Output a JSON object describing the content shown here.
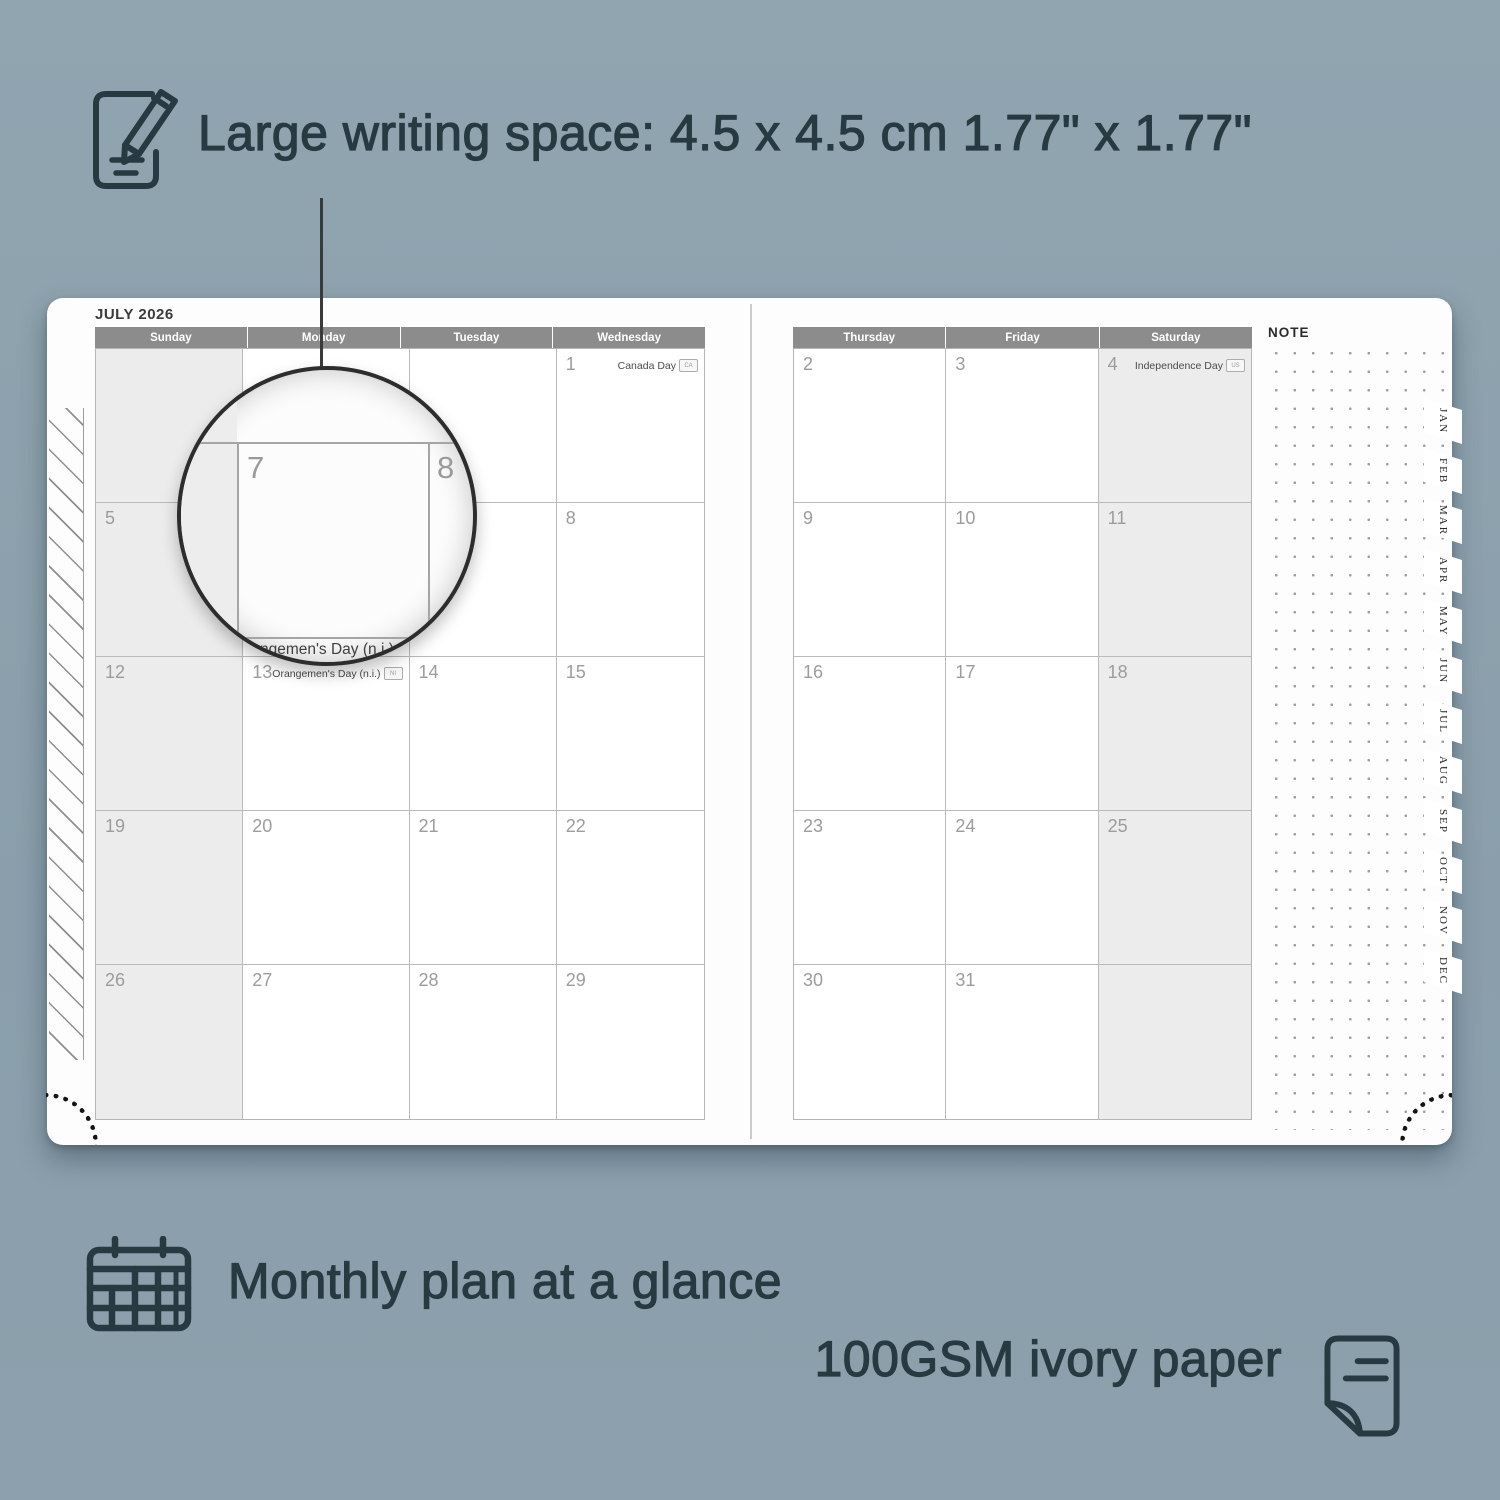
{
  "colors": {
    "background": "#8CA1AD",
    "ink": "#273A41",
    "page": "#FDFDFD",
    "header_bar": "#8C8C8C",
    "header_text": "#FFFFFF",
    "shaded_cell": "#ECECEC",
    "grid_line": "#B5B5B5",
    "date_number": "#9C9C9C"
  },
  "icons": {
    "top": "notepad-pencil-icon",
    "bottom_left": "calendar-grid-icon",
    "bottom_right": "paper-sheet-icon"
  },
  "annotations": {
    "top_label": "Large writing space: 4.5 x 4.5 cm  1.77\" x 1.77\"",
    "bottom_left_label": "Monthly plan at a glance",
    "bottom_right_label": "100GSM ivory paper"
  },
  "planner": {
    "month_title": "JULY 2026",
    "note_label": "NOTE",
    "weekday_headers_left": [
      "Sunday",
      "Monday",
      "Tuesday",
      "Wednesday"
    ],
    "weekday_headers_right": [
      "Thursday",
      "Friday",
      "Saturday"
    ],
    "month_tabs": [
      "JAN",
      "FEB",
      "MAR",
      "APR",
      "MAY",
      "JUN",
      "JUL",
      "AUG",
      "SEP",
      "OCT",
      "NOV",
      "DEC"
    ],
    "left_grid": [
      [
        {
          "date": "",
          "shaded": true
        },
        {
          "date": ""
        },
        {
          "date": ""
        },
        {
          "date": "1",
          "holiday": "Canada Day",
          "flag": "CA"
        }
      ],
      [
        {
          "date": "5",
          "shaded": true
        },
        {
          "date": "6"
        },
        {
          "date": "7"
        },
        {
          "date": "8"
        }
      ],
      [
        {
          "date": "12",
          "shaded": true
        },
        {
          "date": "13",
          "holiday": "Orangemen's Day (n.i.)",
          "flag": "NI"
        },
        {
          "date": "14"
        },
        {
          "date": "15"
        }
      ],
      [
        {
          "date": "19",
          "shaded": true
        },
        {
          "date": "20"
        },
        {
          "date": "21"
        },
        {
          "date": "22"
        }
      ],
      [
        {
          "date": "26",
          "shaded": true
        },
        {
          "date": "27"
        },
        {
          "date": "28"
        },
        {
          "date": "29"
        }
      ]
    ],
    "right_grid": [
      [
        {
          "date": "2"
        },
        {
          "date": "3"
        },
        {
          "date": "4",
          "holiday": "Independence Day",
          "flag": "US",
          "shaded": true
        }
      ],
      [
        {
          "date": "9"
        },
        {
          "date": "10"
        },
        {
          "date": "11",
          "shaded": true
        }
      ],
      [
        {
          "date": "16"
        },
        {
          "date": "17"
        },
        {
          "date": "18",
          "shaded": true
        }
      ],
      [
        {
          "date": "23"
        },
        {
          "date": "24"
        },
        {
          "date": "25",
          "shaded": true
        }
      ],
      [
        {
          "date": "30"
        },
        {
          "date": "31"
        },
        {
          "date": "",
          "shaded": true
        }
      ]
    ],
    "magnifier": {
      "left_date": "7",
      "right_date": "8",
      "holiday_label": "Orangemen's Day (n.i.)"
    }
  }
}
